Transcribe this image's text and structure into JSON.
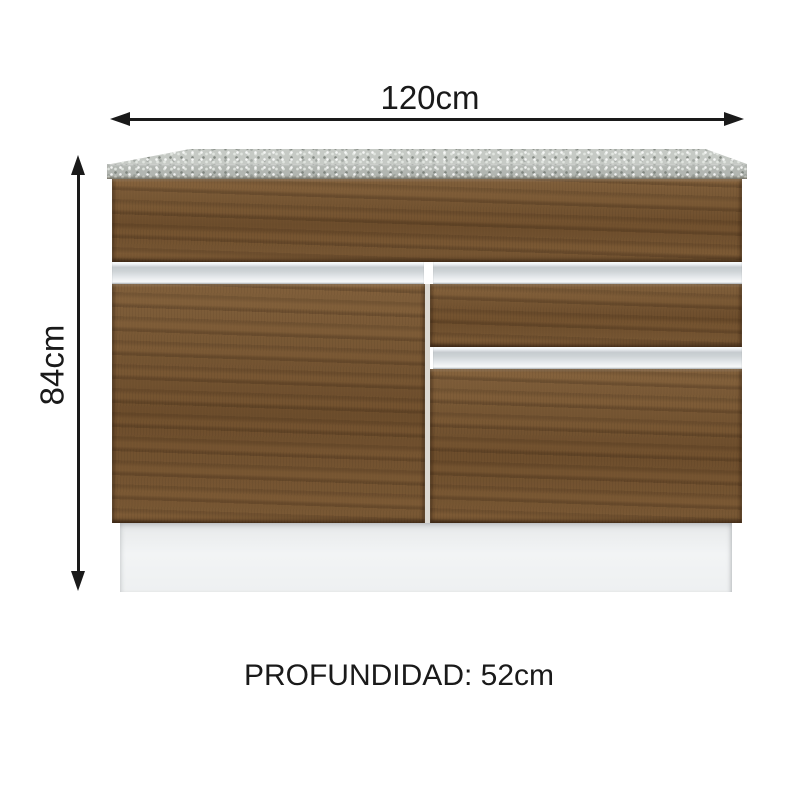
{
  "diagram": {
    "type": "furniture-dimension-diagram",
    "product": "kitchen-sink-base-cabinet"
  },
  "dimensions": {
    "width": {
      "label": "120cm"
    },
    "height": {
      "label": "84cm"
    },
    "depth": {
      "label": "PROFUNDIDAD: 52cm"
    }
  },
  "colors": {
    "annotation": "#1a1a1a",
    "wood": "#75532f",
    "countertop-top": "#c6cac5",
    "countertop-front": "#b2b6b1",
    "handle-strip": "#d9dde0",
    "plinth": "#eef0f1",
    "background": "#ffffff"
  }
}
